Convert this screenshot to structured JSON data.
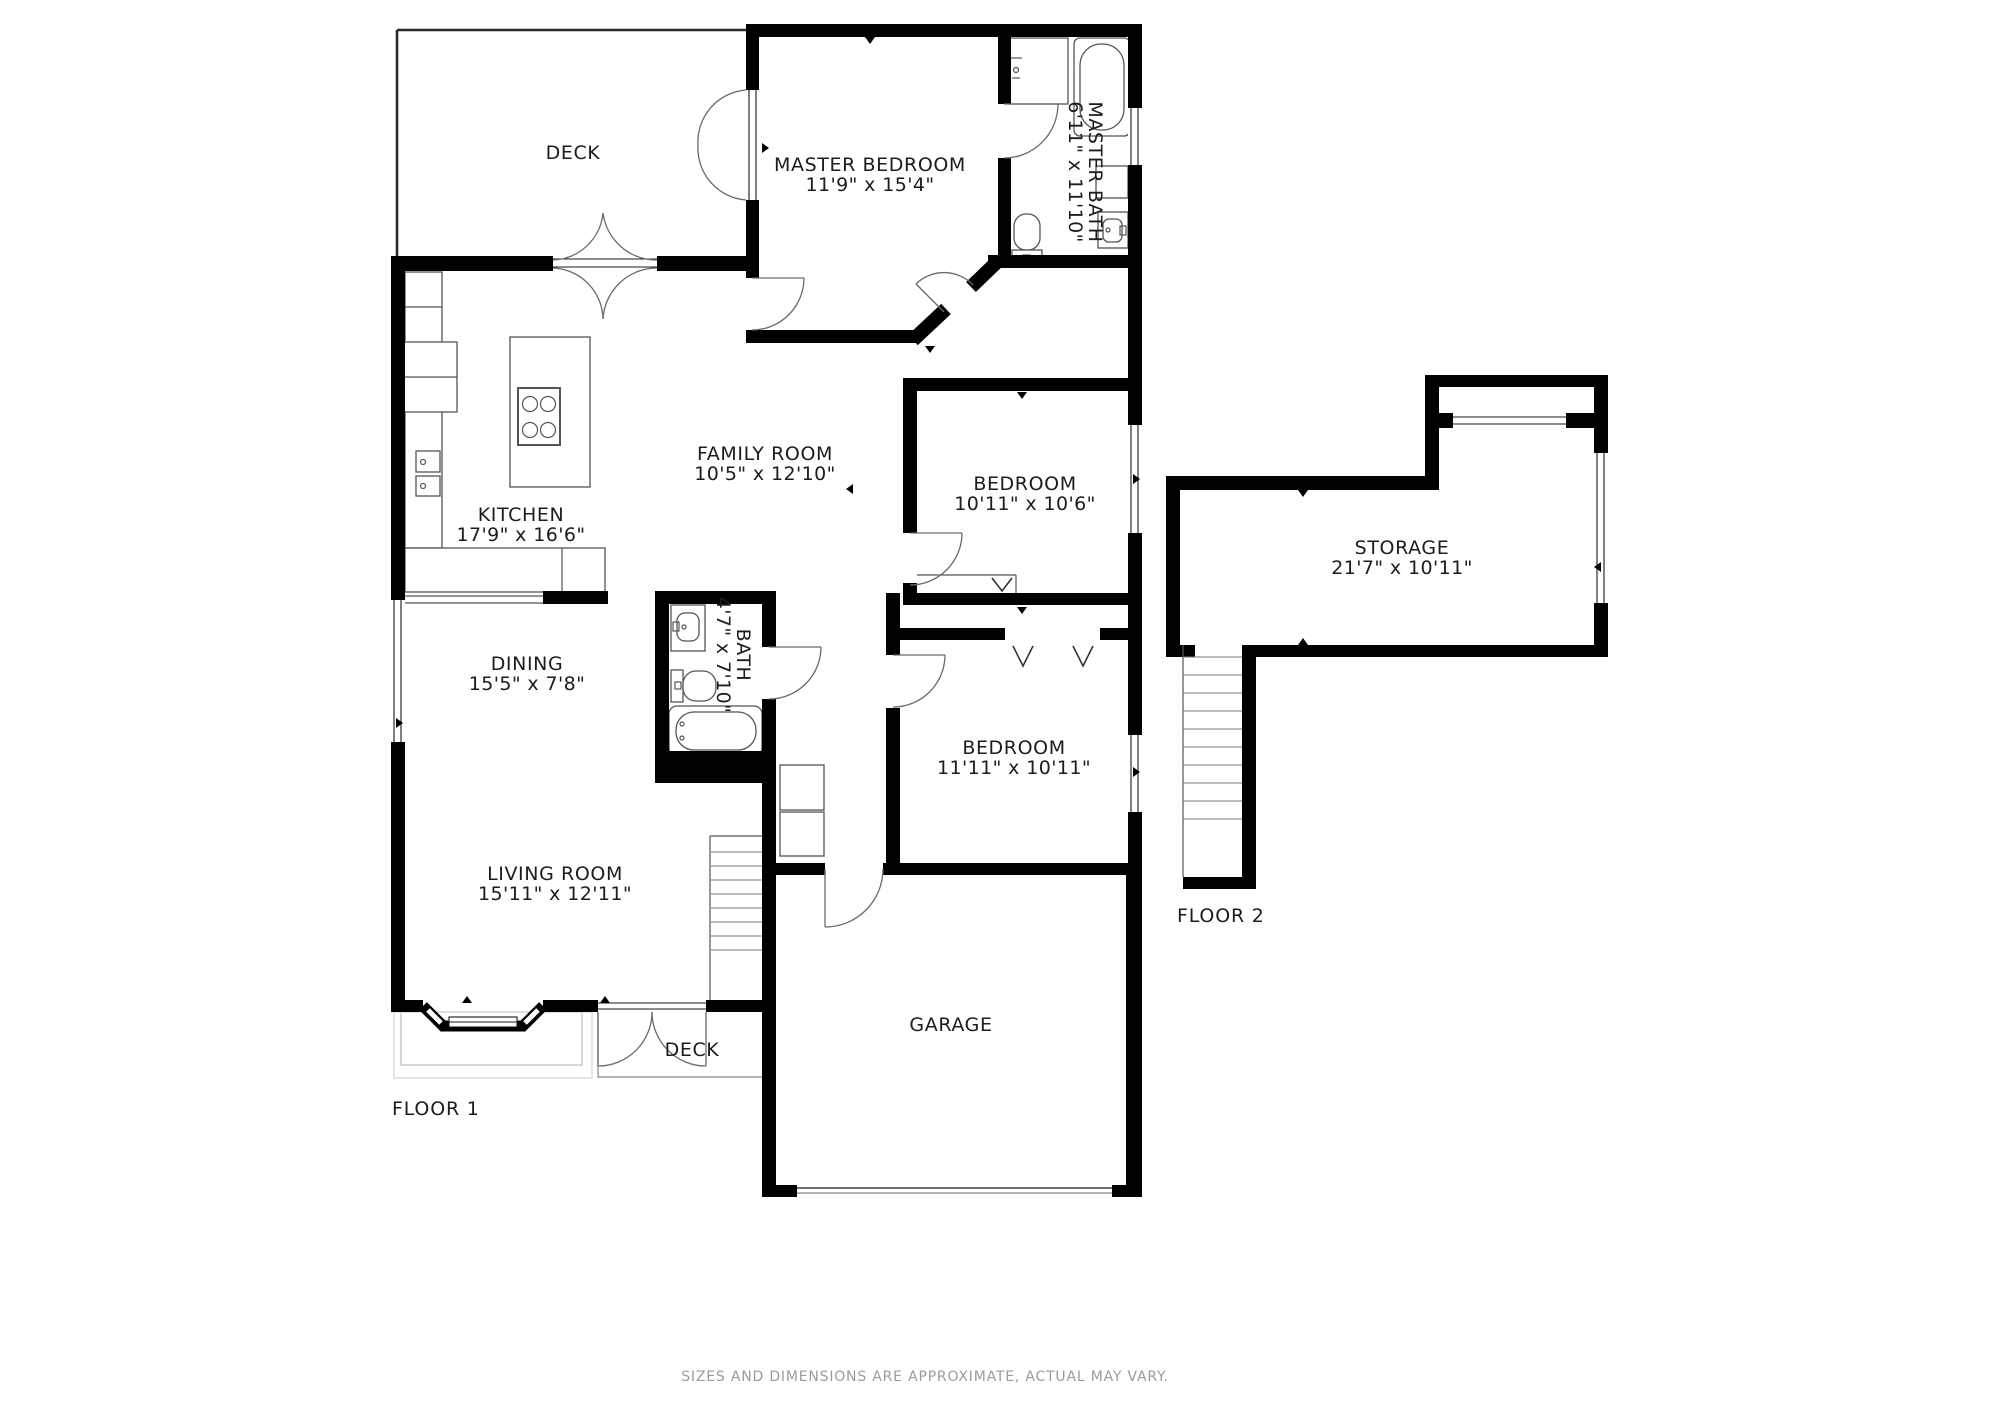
{
  "footer": {
    "disclaimer": "SIZES AND DIMENSIONS ARE APPROXIMATE, ACTUAL MAY VARY."
  },
  "floor1": {
    "label": "FLOOR 1",
    "rooms": {
      "deck_top": {
        "name": "DECK"
      },
      "master_bedroom": {
        "name": "MASTER BEDROOM",
        "dims": "11'9\" x 15'4\""
      },
      "master_bath": {
        "name": "MASTER BATH",
        "dims": "6'11\" x 11'10\""
      },
      "kitchen": {
        "name": "KITCHEN",
        "dims": "17'9\" x 16'6\""
      },
      "family_room": {
        "name": "FAMILY ROOM",
        "dims": "10'5\" x 12'10\""
      },
      "bedroom1": {
        "name": "BEDROOM",
        "dims": "10'11\" x 10'6\""
      },
      "dining": {
        "name": "DINING",
        "dims": "15'5\" x 7'8\""
      },
      "bath": {
        "name": "BATH",
        "dims": "4'7\" x 7'10\""
      },
      "bedroom2": {
        "name": "BEDROOM",
        "dims": "11'11\" x 10'11\""
      },
      "living_room": {
        "name": "LIVING ROOM",
        "dims": "15'11\" x 12'11\""
      },
      "garage": {
        "name": "GARAGE"
      },
      "deck_bottom": {
        "name": "DECK"
      }
    }
  },
  "floor2": {
    "label": "FLOOR 2",
    "rooms": {
      "storage": {
        "name": "STORAGE",
        "dims": "21'7\" x 10'11\""
      }
    }
  }
}
